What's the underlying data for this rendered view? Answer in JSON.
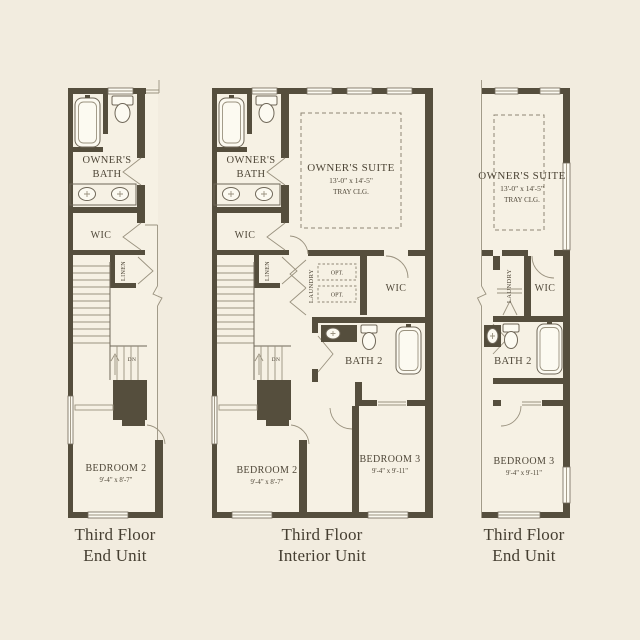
{
  "page": {
    "background": "#f2ecdf",
    "floor_fill": "#f6f1e4",
    "wall_color": "#554e3d",
    "line_color": "#6f6758",
    "text_color": "#4e4637"
  },
  "plans": [
    {
      "id": "left-end-unit",
      "caption": {
        "line1": "Third Floor",
        "line2": "End Unit"
      },
      "labels": {
        "owners_bath_1": "OWNER'S",
        "owners_bath_2": "BATH",
        "wic": "WIC",
        "linen": "LINEN",
        "dn": "DN",
        "bedroom2_name": "BEDROOM 2",
        "bedroom2_dims": "9'-4\" x 8'-7\""
      }
    },
    {
      "id": "interior-unit",
      "caption": {
        "line1": "Third Floor",
        "line2": "Interior Unit"
      },
      "labels": {
        "owners_bath_1": "OWNER'S",
        "owners_bath_2": "BATH",
        "wic": "WIC",
        "linen": "LINEN",
        "dn": "DN",
        "owners_suite_name": "OWNER'S SUITE",
        "owners_suite_dims": "13'-0\" x 14'-5\"",
        "owners_suite_clg": "TRAY CLG.",
        "laundry": "LAUNDRY",
        "opt_top": "OPT.",
        "opt_bottom": "OPT.",
        "wic2": "WIC",
        "bath2": "BATH 2",
        "bedroom2_name": "BEDROOM 2",
        "bedroom2_dims": "9'-4\" x 8'-7\"",
        "bedroom3_name": "BEDROOM 3",
        "bedroom3_dims": "9'-4\" x 9'-11\""
      }
    },
    {
      "id": "right-end-unit",
      "caption": {
        "line1": "Third Floor",
        "line2": "End Unit"
      },
      "labels": {
        "owners_suite_name": "OWNER'S SUITE",
        "owners_suite_dims": "13'-0\" x 14'-5\"",
        "owners_suite_clg": "TRAY CLG.",
        "laundry": "LAUNDRY",
        "wic": "WIC",
        "bath2": "BATH 2",
        "bedroom3_name": "BEDROOM 3",
        "bedroom3_dims": "9'-4\" x 9'-11\""
      }
    }
  ]
}
